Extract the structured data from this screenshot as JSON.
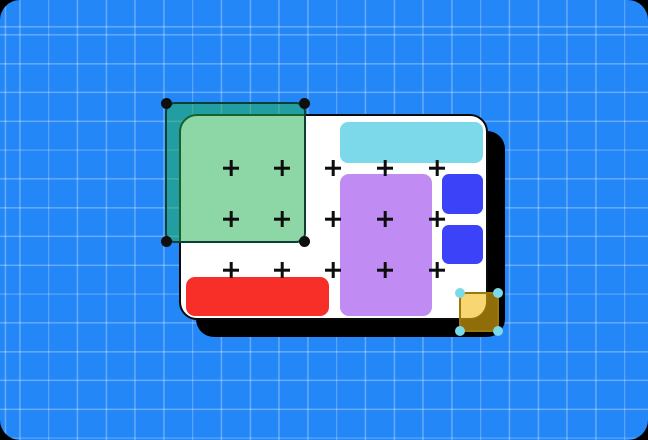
{
  "palette": {
    "page_corner_background": "#000000",
    "canvas_blue": "#2387f7",
    "grid_line": "rgba(255,255,255,0.30)",
    "artboard_fill": "#ffffff",
    "artboard_outline": "#0a0a0a",
    "artboard_shadow": "#000000",
    "cyan_bar": "#7cd9ea",
    "purple_rect": "#c08cf3",
    "blue_square": "#3b42f8",
    "red_bar": "#f82e29",
    "green_overlay_fill": "rgba(34,178,83,0.52)",
    "green_overlay_stroke": "#0d4035",
    "green_handle": "#0f0f0f",
    "gold_overlay_fill": "rgba(243,187,17,0.59)",
    "gold_overlay_stroke": "#9a780c",
    "gold_handle": "#7cd9ea",
    "plus_mark": "#0d0d0d"
  },
  "plus_grid": {
    "columns_x": [
      231,
      282,
      333,
      385,
      437
    ],
    "rows_y": [
      168,
      219,
      270
    ],
    "size": 16,
    "stroke": 2.6
  }
}
